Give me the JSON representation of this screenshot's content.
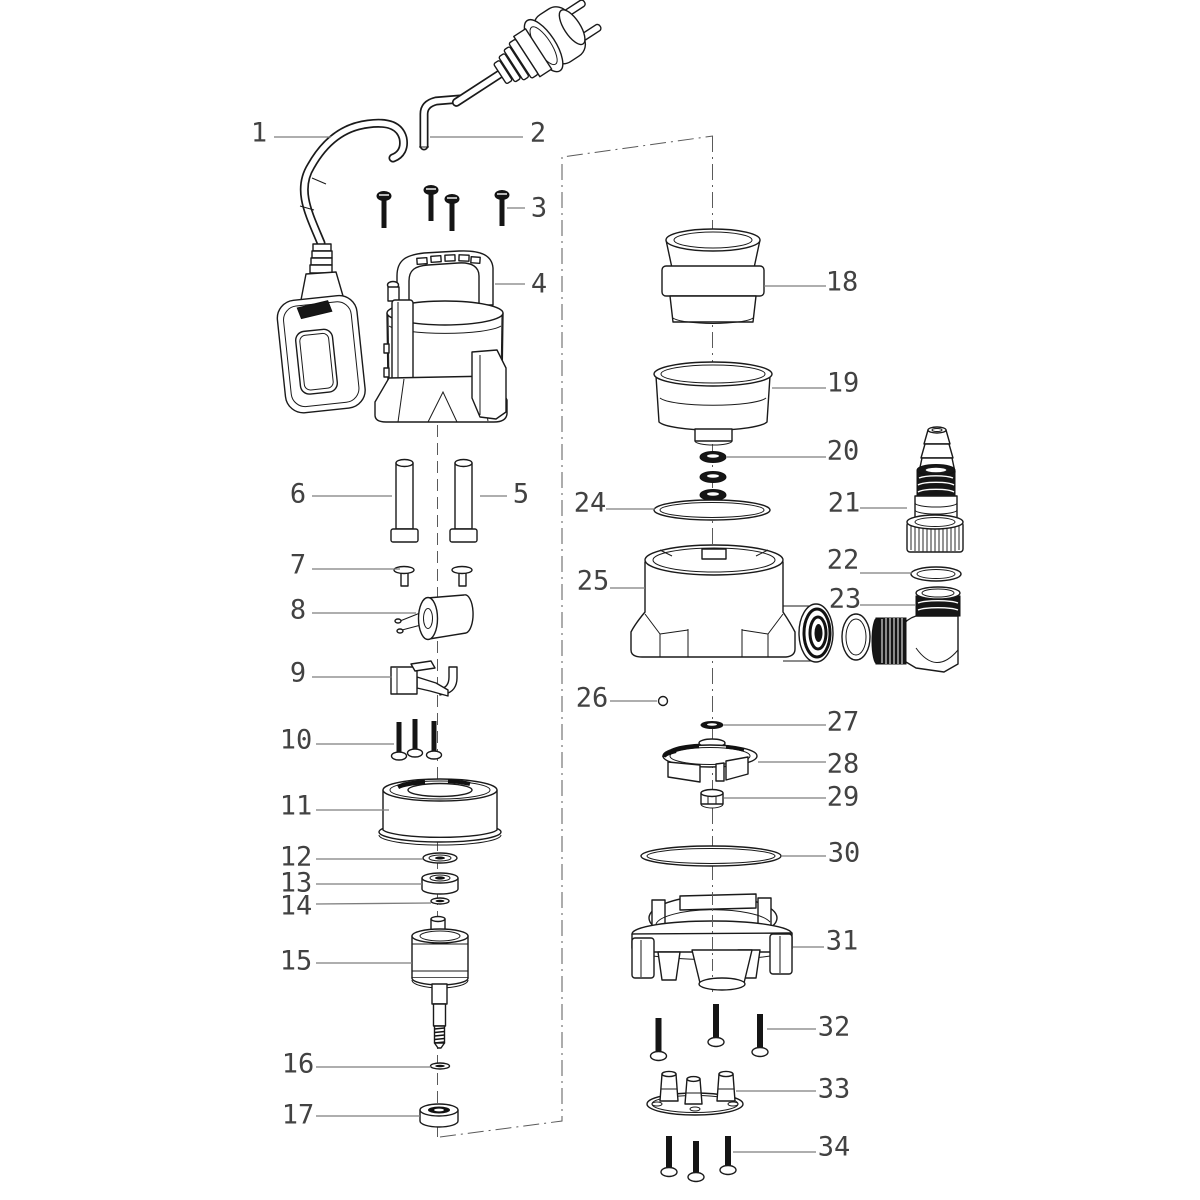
{
  "diagram": {
    "kind": "exploded-parts-diagram",
    "background_color": "#ffffff",
    "line_color": "#1a1a1a",
    "leader_color": "#7d7d7d",
    "label_color": "#424242",
    "callouts": [
      {
        "number": "1",
        "part": "float-switch-with-cable"
      },
      {
        "number": "2",
        "part": "power-cord-with-plug"
      },
      {
        "number": "3",
        "part": "top-cover-screws"
      },
      {
        "number": "4",
        "part": "pump-housing-with-handle"
      },
      {
        "number": "5",
        "part": "guide-pin-right"
      },
      {
        "number": "6",
        "part": "guide-pin-left"
      },
      {
        "number": "7",
        "part": "push-rivets"
      },
      {
        "number": "8",
        "part": "capacitor"
      },
      {
        "number": "9",
        "part": "switch-bracket"
      },
      {
        "number": "10",
        "part": "motor-screws"
      },
      {
        "number": "11",
        "part": "stator-housing"
      },
      {
        "number": "12",
        "part": "washer"
      },
      {
        "number": "13",
        "part": "bearing"
      },
      {
        "number": "14",
        "part": "small-washer"
      },
      {
        "number": "15",
        "part": "rotor-with-shaft"
      },
      {
        "number": "16",
        "part": "shaft-washer"
      },
      {
        "number": "17",
        "part": "mechanical-seal"
      },
      {
        "number": "18",
        "part": "stepped-hose-adapter"
      },
      {
        "number": "19",
        "part": "outlet-connector-cup"
      },
      {
        "number": "20",
        "part": "o-ring-set"
      },
      {
        "number": "21",
        "part": "hose-connector-with-nut"
      },
      {
        "number": "22",
        "part": "flat-gasket"
      },
      {
        "number": "23",
        "part": "elbow-fitting"
      },
      {
        "number": "24",
        "part": "large-o-ring"
      },
      {
        "number": "25",
        "part": "pump-volute-housing"
      },
      {
        "number": "26",
        "part": "valve-ball"
      },
      {
        "number": "27",
        "part": "impeller-washer"
      },
      {
        "number": "28",
        "part": "impeller"
      },
      {
        "number": "29",
        "part": "impeller-nut"
      },
      {
        "number": "30",
        "part": "base-o-ring"
      },
      {
        "number": "31",
        "part": "pump-base"
      },
      {
        "number": "32",
        "part": "base-screws-upper"
      },
      {
        "number": "33",
        "part": "foot-plate"
      },
      {
        "number": "34",
        "part": "base-screws-lower"
      }
    ]
  }
}
